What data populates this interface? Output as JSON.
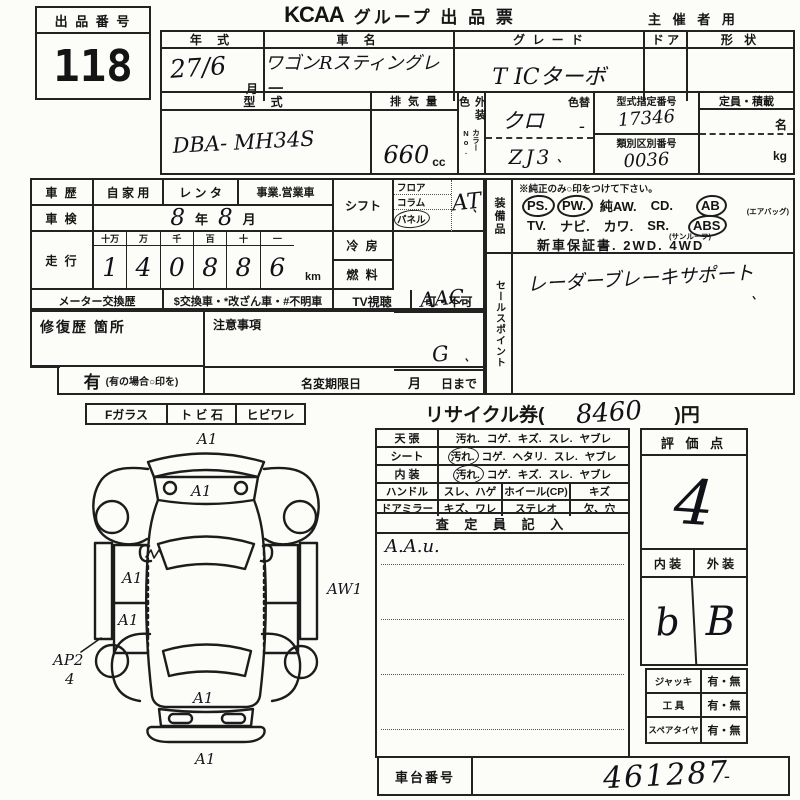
{
  "header": {
    "lot_label": "出 品 番 号",
    "lot_number": "118",
    "logo": "KCAA",
    "title": "グループ 出 品 票",
    "corner": "主 催 者 用"
  },
  "table_a": {
    "year_label": "年 式",
    "year_value": "27/6",
    "month_unit": "月",
    "name_label": "車 名",
    "name_value": "ワゴンRスティングレー",
    "grade_label": "グ レ ー ド",
    "grade_value": "T ICターボ",
    "door_label": "ド ア",
    "shape_label": "形 状"
  },
  "table_b": {
    "model_label": "型 式",
    "model_value": "DBA- MH34S",
    "disp_label": "排 気 量",
    "disp_value": "660",
    "disp_unit": "cc",
    "ext_color_label": "外装色",
    "color_no_label": "カラーNo.",
    "color_change_label": "色替",
    "color_value": "クロ",
    "color_change_value": "-",
    "color_no_value": "ZJ3",
    "cert_label": "型式指定番号",
    "cert_value": "17346",
    "class_label": "類別区別番号",
    "class_value": "0036",
    "capacity_label": "定員・積載",
    "capacity_persons_unit": "名",
    "capacity_weight_unit": "kg"
  },
  "history": {
    "label": "車 歴",
    "opt_private": "自 家 用",
    "opt_rental": "レ ン タ",
    "opt_business": "事業.営業車"
  },
  "shaken": {
    "label": "車 検",
    "year_value": "8",
    "year_unit": "年",
    "month_value": "8",
    "month_unit": "月"
  },
  "mileage": {
    "label": "走 行",
    "place_labels": [
      "十万",
      "万",
      "千",
      "百",
      "十",
      "一"
    ],
    "digits": [
      "1",
      "4",
      "0",
      "8",
      "8",
      "6"
    ],
    "unit": "km"
  },
  "meter": {
    "label": "メーター交換歴",
    "legend": "$交換車・*改ざん車・#不明車"
  },
  "shift": {
    "label": "シフト",
    "options": [
      "フロア",
      "コラム",
      "パネル"
    ],
    "value": "AT"
  },
  "aircon": {
    "label": "冷 房",
    "value": "AAC"
  },
  "fuel": {
    "label": "燃 料",
    "value": "G"
  },
  "tv": {
    "label": "TV視聴",
    "value": "可・不可"
  },
  "repair": {
    "label": "修復歴  箇所",
    "yes_label": "有",
    "yes_note": "(有の場合○印を)"
  },
  "notes": {
    "label": "注意事項",
    "deadline_label": "名変期限日",
    "month_unit": "月",
    "day_suffix": "日まで"
  },
  "equipment": {
    "side_label": "装備品",
    "note": "※純正のみ○印をつけて下さい。",
    "row1": [
      "PS.",
      "PW.",
      "純AW.",
      "CD.",
      "AB"
    ],
    "row1_sub": "(エアバッグ)",
    "row2": [
      "TV.",
      "ナビ.",
      "カワ.",
      "SR.",
      "ABS"
    ],
    "row2_sub": "(サンルーフ)",
    "row3": "新車保証書.  2WD.  4WD"
  },
  "sales_point": {
    "side_label": "セールスポイント",
    "value": "レーダーブレーキサポート"
  },
  "glass": {
    "f_label": "Fガラス",
    "stone_label": "ト ビ 石",
    "crack_label": "ヒビワレ"
  },
  "recycle": {
    "prefix": "リサイクル券(",
    "value": "8460",
    "suffix": ")円"
  },
  "condition": {
    "rows": [
      {
        "label": "天  張",
        "opts": [
          "汚れ.",
          "コゲ.",
          "キズ.",
          "スレ.",
          "ヤブレ"
        ]
      },
      {
        "label": "シート",
        "opts": [
          "汚れ.",
          "コゲ.",
          "ヘタリ.",
          "スレ.",
          "ヤブレ"
        ]
      },
      {
        "label": "内  装",
        "opts": [
          "汚れ.",
          "コゲ.",
          "キズ.",
          "スレ.",
          "ヤブレ"
        ]
      }
    ],
    "row4": {
      "label": "ハンドル",
      "value": "スレ、ハゲ",
      "label2": "ホイール(CP)",
      "value2": "キズ"
    },
    "row5": {
      "label": "ドアミラー",
      "value": "キズ、ワレ",
      "label2": "ステレオ",
      "value2": "欠、穴"
    }
  },
  "assessor": {
    "header": "査 定 員 記 入",
    "note": "A.A.u."
  },
  "score": {
    "label": "評 価 点",
    "value": "4"
  },
  "int_ext": {
    "int_label": "内 装",
    "ext_label": "外 装",
    "int_value": "b",
    "ext_value": "B"
  },
  "accessories": {
    "rows": [
      {
        "label": "ジャッキ",
        "value": "有・無"
      },
      {
        "label": "工  具",
        "value": "有・無"
      },
      {
        "label": "スペアタイヤ",
        "value": "有・無"
      }
    ]
  },
  "chassis": {
    "label": "車台番号",
    "value": "461287",
    "mark": "-"
  },
  "marks": {
    "tick": "、"
  },
  "diagram": {
    "front_top": "A1",
    "hood": "A1",
    "left_panel_upper": "A1",
    "left_panel_lower": "A1",
    "right_side": "AW1",
    "left_sill": "AP2",
    "left_sill_count": "4",
    "rear": "A1",
    "rear_bottom": "A1"
  }
}
